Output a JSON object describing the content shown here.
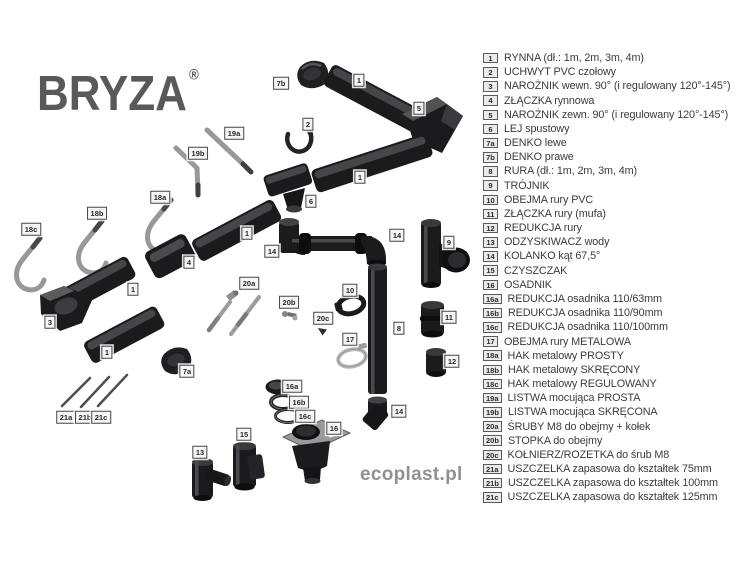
{
  "brand": {
    "logo": "BRYZA",
    "registered": "®",
    "watermark": "ecoplast.pl"
  },
  "colors": {
    "part_black": "#1b1b1d",
    "part_highlight": "#46464a",
    "part_metal": "#97999c",
    "logo_gray": "#58595b",
    "watermark_gray": "#8f9194",
    "legend_text": "#3b3b3d",
    "tag_background": "#ebebe9"
  },
  "legend": {
    "items": [
      {
        "id": "1",
        "label": "RYNNA (dł.: 1m, 2m, 3m, 4m)"
      },
      {
        "id": "2",
        "label": "UCHWYT PVC czołowy"
      },
      {
        "id": "3",
        "label": "NAROŻNIK wewn. 90° (i regulowany 120°-145°)"
      },
      {
        "id": "4",
        "label": "ZŁĄCZKA rynnowa"
      },
      {
        "id": "5",
        "label": "NAROŻNIK zewn. 90° (i regulowany 120°-145°)"
      },
      {
        "id": "6",
        "label": "LEJ spustowy"
      },
      {
        "id": "7a",
        "label": "DENKO lewe"
      },
      {
        "id": "7b",
        "label": "DENKO prawe"
      },
      {
        "id": "8",
        "label": "RURA (dł.: 1m, 2m, 3m, 4m)"
      },
      {
        "id": "9",
        "label": "TRÓJNIK"
      },
      {
        "id": "10",
        "label": "OBEJMA rury PVC"
      },
      {
        "id": "11",
        "label": "ZŁĄCZKA rury (mufa)"
      },
      {
        "id": "12",
        "label": "REDUKCJA rury"
      },
      {
        "id": "13",
        "label": "ODZYSKIWACZ wody"
      },
      {
        "id": "14",
        "label": "KOLANKO kąt 67,5°"
      },
      {
        "id": "15",
        "label": "CZYSZCZAK"
      },
      {
        "id": "16",
        "label": "OSADNIK"
      },
      {
        "id": "16a",
        "label": "REDUKCJA osadnika 110/63mm"
      },
      {
        "id": "16b",
        "label": "REDUKCJA osadnika 110/90mm"
      },
      {
        "id": "16c",
        "label": "REDUKCJA osadnika 110/100mm"
      },
      {
        "id": "17",
        "label": "OBEJMA rury METALOWA"
      },
      {
        "id": "18a",
        "label": "HAK metalowy PROSTY"
      },
      {
        "id": "18b",
        "label": "HAK metalowy SKRĘCONY"
      },
      {
        "id": "18c",
        "label": "HAK metalowy REGULOWANY"
      },
      {
        "id": "19a",
        "label": "LISTWA mocująca PROSTA"
      },
      {
        "id": "19b",
        "label": "LISTWA mocująca SKRĘCONA"
      },
      {
        "id": "20a",
        "label": "ŚRUBY M8 do obejmy + kołek"
      },
      {
        "id": "20b",
        "label": "STOPKA do obejmy"
      },
      {
        "id": "20c",
        "label": "KOŁNIERZ/ROZETKA do śrub M8"
      },
      {
        "id": "21a",
        "label": "USZCZELKA zapasowa do kształtek 75mm"
      },
      {
        "id": "21b",
        "label": "USZCZELKA zapasowa do kształtek 100mm"
      },
      {
        "id": "21c",
        "label": "USZCZELKA zapasowa do kształtek 125mm"
      }
    ]
  },
  "diagram": {
    "callouts": [
      {
        "id": "7b",
        "x": 281,
        "y": 83
      },
      {
        "id": "1",
        "x": 359,
        "y": 80
      },
      {
        "id": "5",
        "x": 419,
        "y": 108
      },
      {
        "id": "2",
        "x": 308,
        "y": 124
      },
      {
        "id": "19a",
        "x": 234,
        "y": 133
      },
      {
        "id": "19b",
        "x": 198,
        "y": 153
      },
      {
        "id": "1",
        "x": 360,
        "y": 177
      },
      {
        "id": "18a",
        "x": 160,
        "y": 197
      },
      {
        "id": "6",
        "x": 311,
        "y": 201
      },
      {
        "id": "18b",
        "x": 97,
        "y": 213
      },
      {
        "id": "18c",
        "x": 31,
        "y": 229
      },
      {
        "id": "1",
        "x": 247,
        "y": 233
      },
      {
        "id": "14",
        "x": 397,
        "y": 235
      },
      {
        "id": "9",
        "x": 449,
        "y": 242
      },
      {
        "id": "14",
        "x": 272,
        "y": 251
      },
      {
        "id": "4",
        "x": 189,
        "y": 262
      },
      {
        "id": "20a",
        "x": 249,
        "y": 283
      },
      {
        "id": "1",
        "x": 133,
        "y": 289
      },
      {
        "id": "10",
        "x": 350,
        "y": 290
      },
      {
        "id": "20b",
        "x": 289,
        "y": 302
      },
      {
        "id": "11",
        "x": 449,
        "y": 317
      },
      {
        "id": "20c",
        "x": 323,
        "y": 318
      },
      {
        "id": "3",
        "x": 50,
        "y": 322
      },
      {
        "id": "8",
        "x": 399,
        "y": 328
      },
      {
        "id": "17",
        "x": 350,
        "y": 339
      },
      {
        "id": "1",
        "x": 107,
        "y": 352
      },
      {
        "id": "12",
        "x": 452,
        "y": 361
      },
      {
        "id": "7a",
        "x": 187,
        "y": 371
      },
      {
        "id": "16a",
        "x": 292,
        "y": 386
      },
      {
        "id": "16b",
        "x": 299,
        "y": 402
      },
      {
        "id": "14",
        "x": 399,
        "y": 411
      },
      {
        "id": "16c",
        "x": 305,
        "y": 416
      },
      {
        "id": "21a",
        "x": 66,
        "y": 417
      },
      {
        "id": "21b",
        "x": 85,
        "y": 417
      },
      {
        "id": "21c",
        "x": 101,
        "y": 417
      },
      {
        "id": "16",
        "x": 334,
        "y": 428
      },
      {
        "id": "15",
        "x": 244,
        "y": 434
      },
      {
        "id": "13",
        "x": 200,
        "y": 452
      }
    ]
  }
}
